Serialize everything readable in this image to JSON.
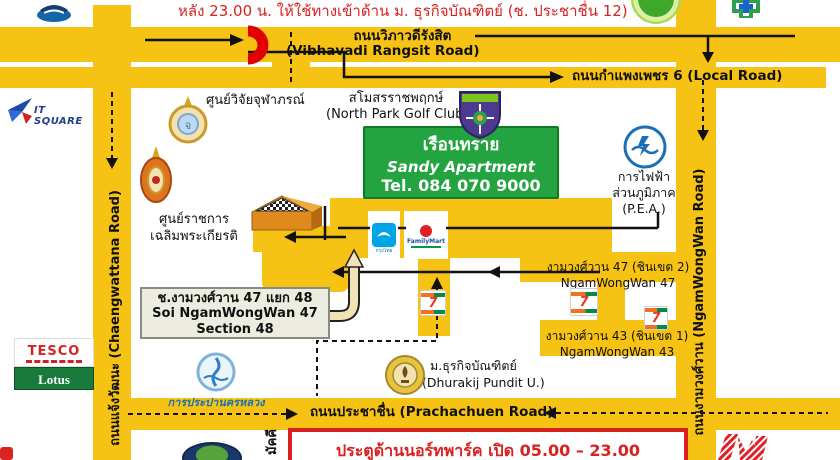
{
  "note_after_hours": "หลัง 23.00 น. ให้ใช้ทางเข้าด้าน ม. ธุรกิจบัณฑิตย์  (ช. ประชาชื่น 12)",
  "roads": {
    "vibhavadi_thai": "ถนนวิภาวดีรังสิต",
    "vibhavadi_eng": "(Vibhavadi Rangsit Road)",
    "local_road": "ถนนกำแพงเพชร 6 (Local Road)",
    "chaengwattana": "ถนนแจ้งวัฒนะ (Chaengwattana Road)",
    "ngamwongwan": "ถนนงามวงศ์วาน (NgamWongWan Road)",
    "prachachuen": "ถนนประชาชื่น (Prachachuen Road)",
    "samakkhi_partial": "มัคคี",
    "soi47_thai": "งามวงศ์วาน 47 (ชินเขต 2)",
    "soi47_eng": "NgamWongWan 47",
    "soi43_thai": "งามวงศ์วาน 43 (ชินเขต 1)",
    "soi43_eng": "NgamWongWan 43"
  },
  "apartment_sign": {
    "name_thai": "เรือนทราย",
    "name_eng": "Sandy Apartment",
    "tel": "Tel. 084 070 9000"
  },
  "soi_callout": {
    "line1": "ช.งามวงศ์วาน 47 แยก 48",
    "line2": "Soi NgamWongWan 47",
    "line3": "Section 48"
  },
  "gate_notice": "ประตูด้านนอร์ทพาร์ค  เปิด 05.00 – 23.00",
  "places": {
    "chulabhorn_research": "ศูนย์วิจัยจุฬาภรณ์",
    "northpark_thai": "สโมสรราชพฤกษ์",
    "northpark_eng": "(North Park Golf Club)",
    "gov_center_line1": "ศูนย์ราชการ",
    "gov_center_line2": "เฉลิมพระเกียรติ",
    "pea_line1": "การไฟฟ้า",
    "pea_line2": "ส่วนภูมิภาค",
    "pea_line3": "(P.E.A.)",
    "dhurakij_thai": "ม.ธุรกิจบัณฑิตย์",
    "dhurakij_eng": "(Dhurakij Pundit U.)",
    "mwa": "การประปานครหลวง"
  },
  "logos": {
    "itsquare": "IT SQUARE",
    "tesco": "TESCO",
    "lotus": "Lotus",
    "familymart": "FamilyMart",
    "krungthai": "กรุงไทย",
    "seven_eleven": "7",
    "sports_city": "SPORTS CITY"
  },
  "colors": {
    "road_yellow": "#F6C214",
    "route_black": "#111111",
    "accent_red": "#D92121",
    "sign_green": "#23A440"
  }
}
